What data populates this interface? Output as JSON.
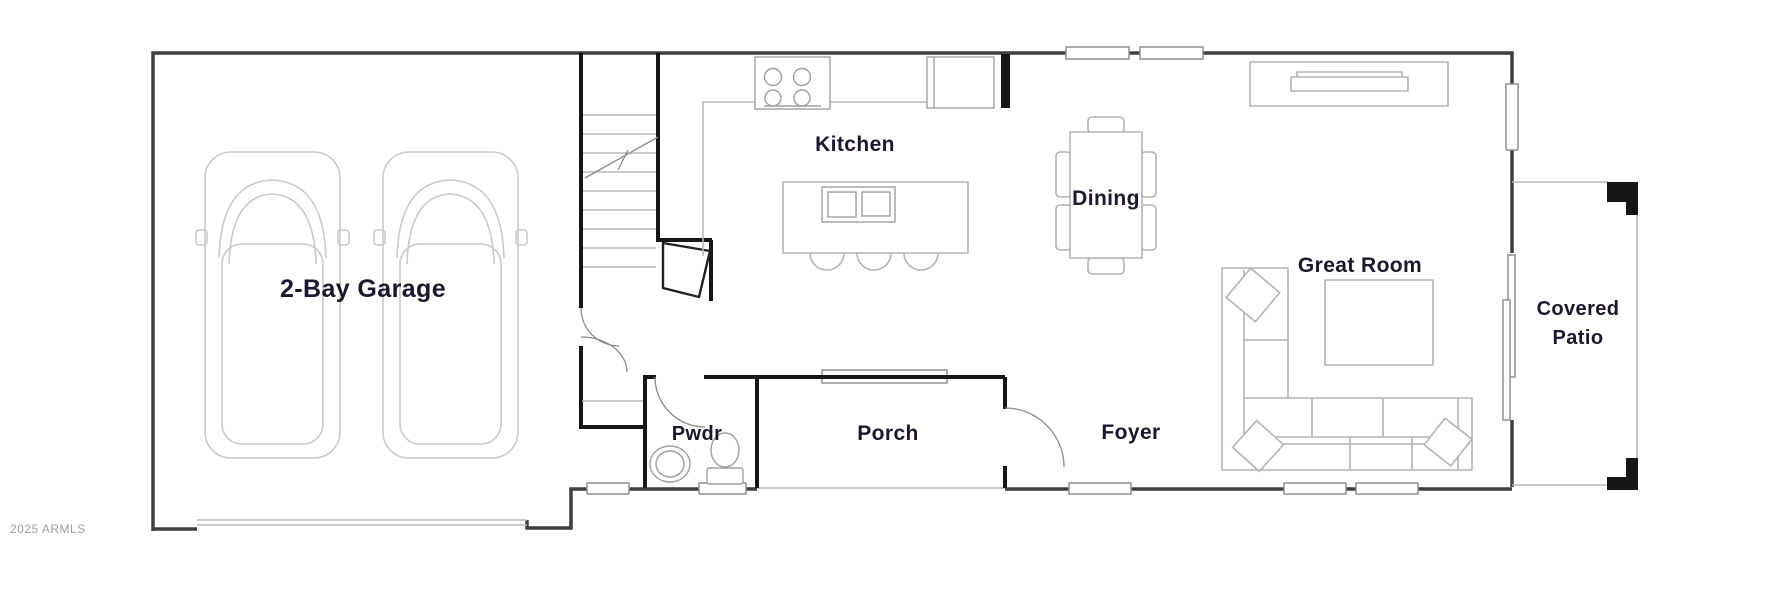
{
  "image_type": "residential floor plan",
  "watermark": "2025 ARMLS",
  "rooms": {
    "garage": {
      "label": "2-Bay Garage"
    },
    "kitchen": {
      "label": "Kitchen"
    },
    "dining": {
      "label": "Dining"
    },
    "great_room": {
      "label": "Great Room"
    },
    "covered_patio": {
      "line1": "Covered",
      "line2": "Patio"
    },
    "powder": {
      "label": "Pwdr"
    },
    "porch": {
      "label": "Porch"
    },
    "foyer": {
      "label": "Foyer"
    }
  },
  "colors": {
    "background": "#ffffff",
    "exterior_wall": "#3f3f3f",
    "interior_wall": "#161616",
    "furniture_line": "#b4b4b4",
    "appliance_line": "#9f9f9f",
    "car_line": "#c9c9c9",
    "window_border": "#8f8f8f",
    "label_text": "#181830",
    "watermark_text": "#9b9b9b"
  }
}
